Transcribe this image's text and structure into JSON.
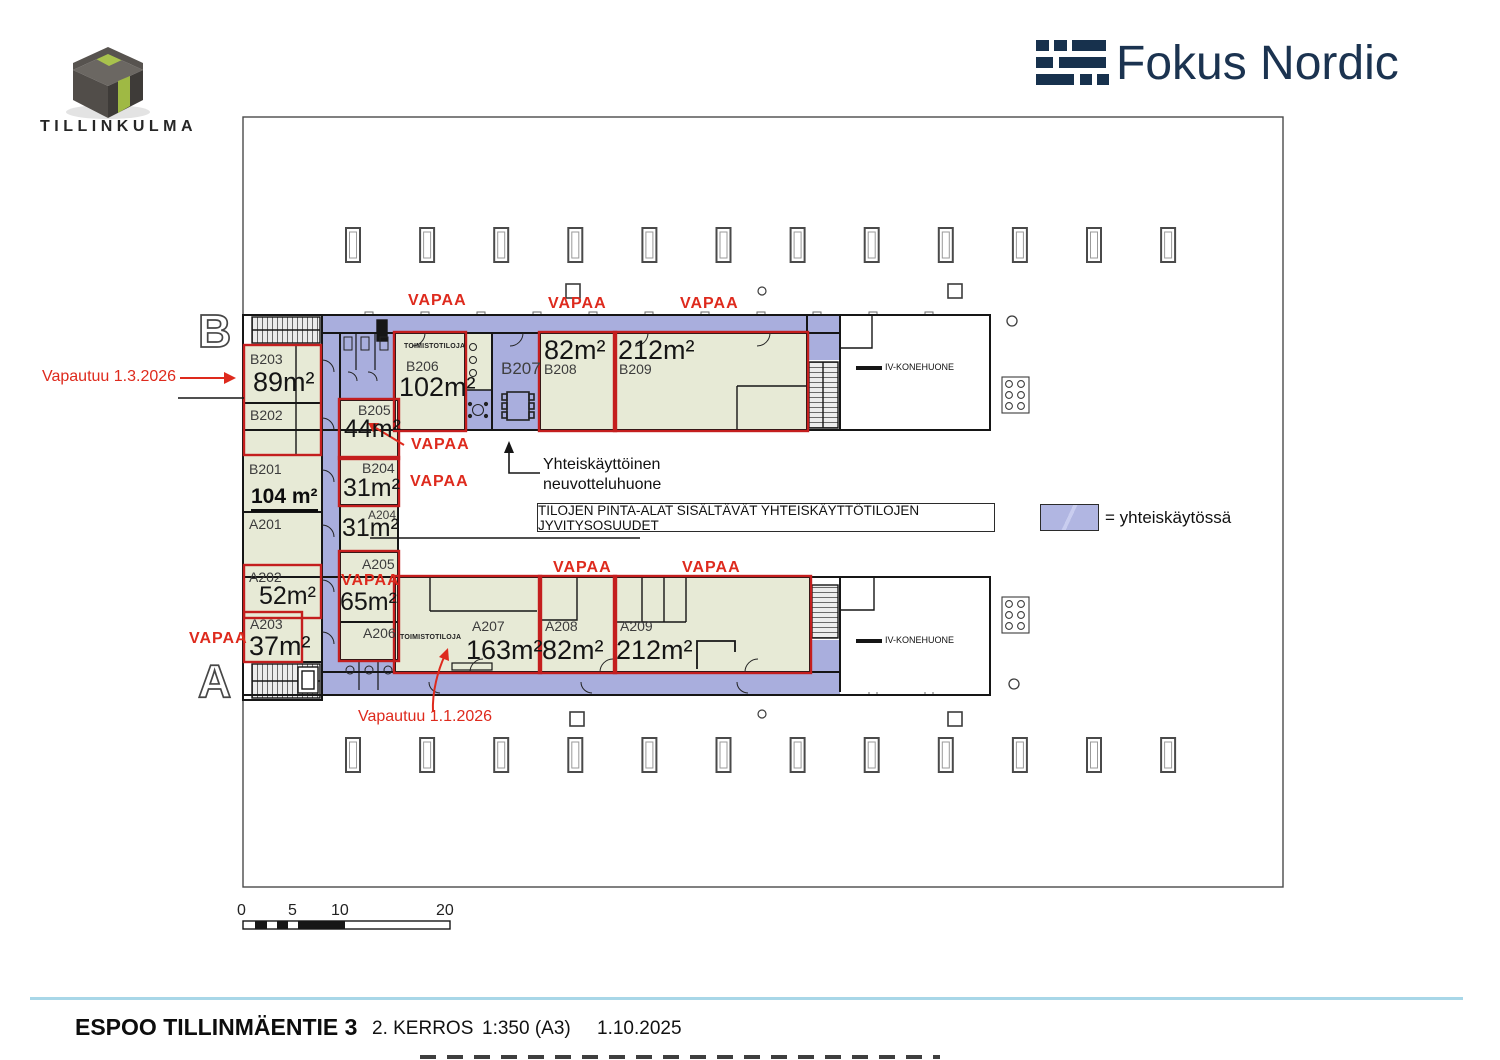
{
  "branding": {
    "tillinkulma_logo_text": "TILLINKULMA",
    "fokus_nordic_logo_text": "Fokus Nordic"
  },
  "plan": {
    "section_letters": {
      "top": "B",
      "bottom": "A"
    },
    "vapaa_label": "VAPAA",
    "rooms": {
      "B203": {
        "id": "B203",
        "area": "89m²"
      },
      "B202": {
        "id": "B202"
      },
      "B201": {
        "id": "B201",
        "area": "104 m²"
      },
      "A201": {
        "id": "A201"
      },
      "A202": {
        "id": "A202",
        "area": "52m²"
      },
      "A203": {
        "id": "A203",
        "area": "37m²"
      },
      "B206": {
        "id": "B206",
        "area": "102m²",
        "type_label": "TOIMISTOTILOJA"
      },
      "B205": {
        "id": "B205",
        "area": "44m²"
      },
      "B204": {
        "id": "B204",
        "area": "31m²"
      },
      "A204": {
        "id": "A204",
        "area": "31m²"
      },
      "A205": {
        "id": "A205",
        "area": "65m²"
      },
      "A206": {
        "id": "A206",
        "type_label": "TOIMISTOTILOJA"
      },
      "B207": {
        "id": "B207"
      },
      "B208": {
        "id": "B208",
        "area": "82m²"
      },
      "B209": {
        "id": "B209",
        "area": "212m²"
      },
      "A207": {
        "id": "A207",
        "area": "163m²"
      },
      "A208": {
        "id": "A208",
        "area": "82m²"
      },
      "A209": {
        "id": "A209",
        "area": "212m²"
      }
    },
    "machine_room_top": "IV-KONEHUONE",
    "machine_room_bottom": "IV-KONEHUONE",
    "annotations": {
      "vapautuu_b203": "Vapautuu 1.3.2026",
      "vapautuu_a206": "Vapautuu 1.1.2026",
      "meeting_line1": "Yhteiskäyttöinen",
      "meeting_line2": "neuvotteluhuone"
    },
    "legend": {
      "note": "TILOJEN PINTA-ALAT SISÄLTÄVÄT YHTEISKÄYTTÖTILOJEN JYVITYSOSUUDET",
      "shared_label": "= yhteiskäytössä"
    },
    "scale_bar": {
      "t0": "0",
      "t5": "5",
      "t10": "10",
      "t20": "20"
    }
  },
  "footer": {
    "address": "ESPOO TILLINMÄENTIE 3",
    "floor": "2. KERROS",
    "scale": "1:350 (A3)",
    "date": "1.10.2025"
  },
  "colors": {
    "shared_fill": "#a9aedd",
    "room_fill": "#e7ead6",
    "available_red": "#c41e1e",
    "brand_navy": "#1b3350"
  }
}
